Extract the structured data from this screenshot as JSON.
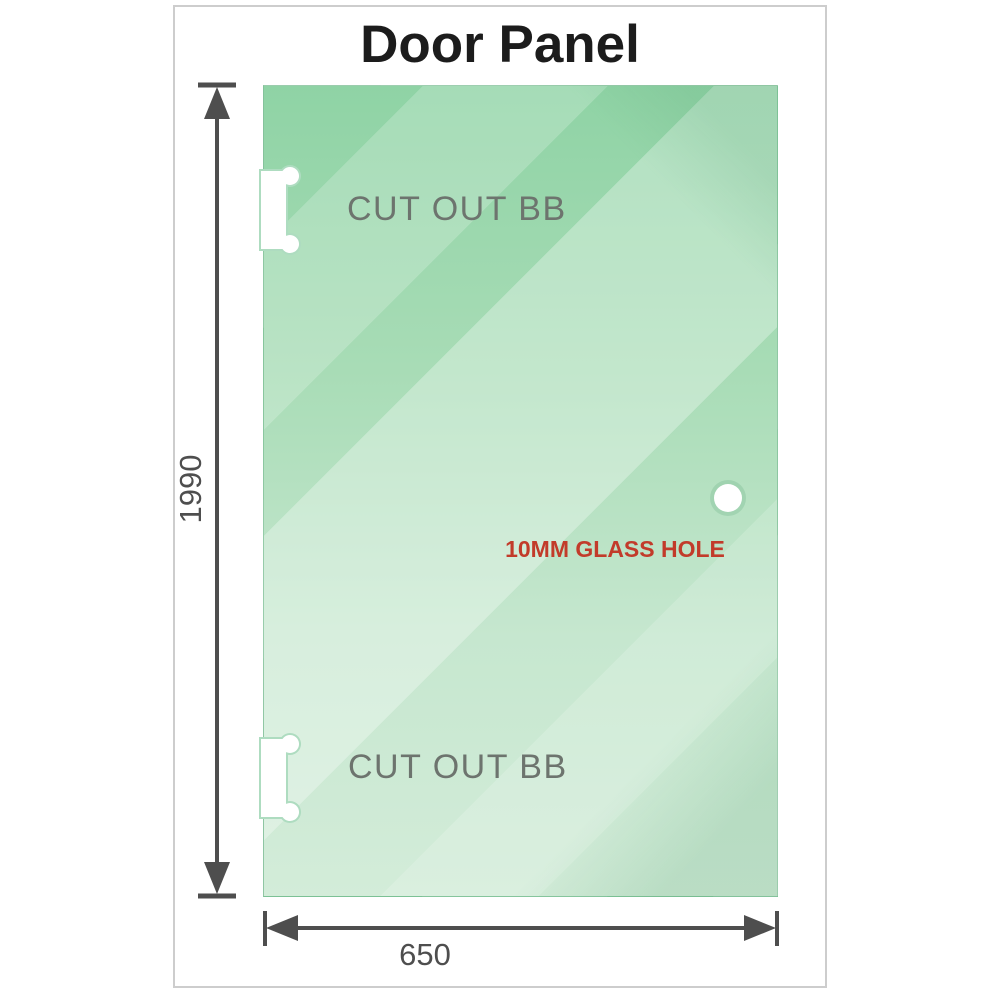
{
  "title": "Door Panel",
  "panel": {
    "cutouts": [
      {
        "label": "CUT OUT BB"
      },
      {
        "label": "CUT OUT BB"
      }
    ],
    "hole_label": "10MM GLASS HOLE"
  },
  "dimensions": {
    "height_mm": "1990",
    "width_mm": "650"
  },
  "colors": {
    "glass_base": "#8fd3a5",
    "glass_light": "#d3ecd9",
    "dimension_line": "#4e4e4e",
    "hole_label_red": "#c23b2a",
    "cutout_label_gray": "#6d746e",
    "title_color": "#1c1c1c",
    "frame_border": "#cdcdcd"
  }
}
